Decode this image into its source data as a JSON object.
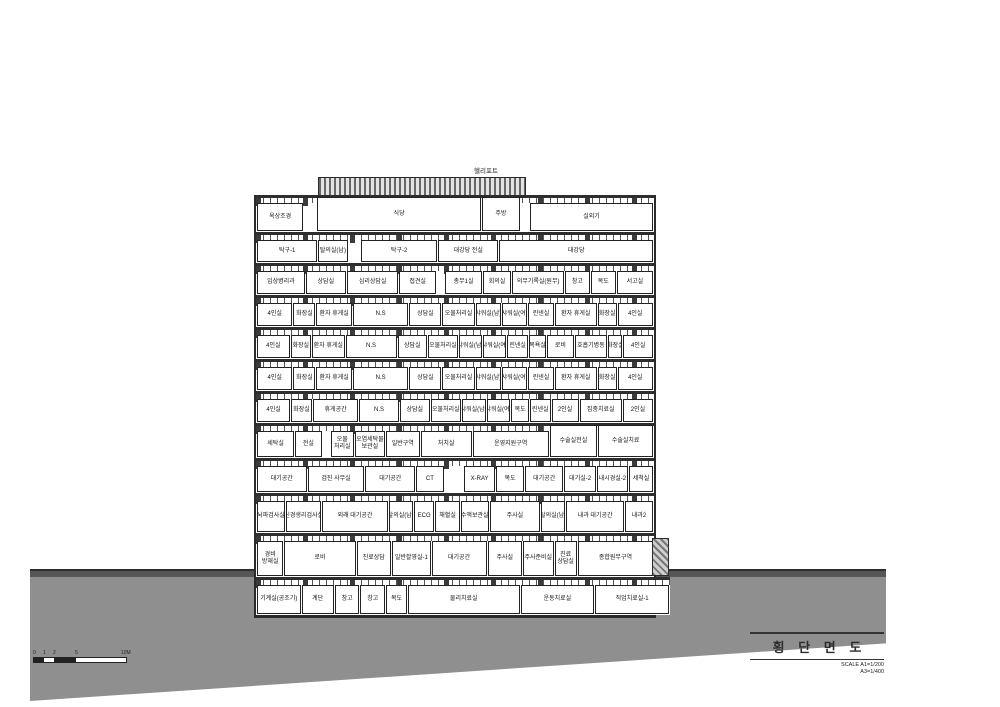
{
  "roof_label": "헬리포트",
  "title_block": {
    "title": "횡 단 면 도",
    "scale_line1": "SCALE  A1=1/200",
    "scale_line2": "A3=1/400"
  },
  "scale_bar": {
    "labels": [
      {
        "t": "0",
        "x": 0
      },
      {
        "t": "1",
        "x": 10
      },
      {
        "t": "2",
        "x": 20
      },
      {
        "t": "5",
        "x": 42
      },
      {
        "t": "10M",
        "x": 88
      }
    ],
    "segments": [
      {
        "w": 10,
        "filled": true
      },
      {
        "w": 10,
        "filled": false
      },
      {
        "w": 22,
        "filled": true
      },
      {
        "w": 50,
        "filled": false
      }
    ]
  },
  "floors": [
    {
      "id": "roof",
      "h": 37,
      "rooms": [
        {
          "label": "옥상조경",
          "w": 11
        },
        {
          "label": "",
          "w": 3
        },
        {
          "label": "식당",
          "w": 40,
          "raised": true
        },
        {
          "label": "주방",
          "w": 9,
          "raised": true
        },
        {
          "label": "",
          "w": 2
        },
        {
          "label": "실외기",
          "w": 30
        }
      ]
    },
    {
      "id": "f11",
      "h": 31,
      "rooms": [
        {
          "label": "탁구-1",
          "w": 15
        },
        {
          "label": "탈의실(남)",
          "w": 7
        },
        {
          "label": "",
          "w": 3
        },
        {
          "label": "탁구-2",
          "w": 19
        },
        {
          "label": "대강당 전실",
          "w": 15
        },
        {
          "label": "대강당",
          "w": 39
        }
      ]
    },
    {
      "id": "f10",
      "h": 32,
      "rooms": [
        {
          "label": "임상병리과",
          "w": 12
        },
        {
          "label": "상담실",
          "w": 10
        },
        {
          "label": "심리상담실",
          "w": 13
        },
        {
          "label": "접견실",
          "w": 9
        },
        {
          "label": "",
          "w": 2
        },
        {
          "label": "총무1실",
          "w": 9
        },
        {
          "label": "회의실",
          "w": 7
        },
        {
          "label": "의무기록실(원무)",
          "w": 13
        },
        {
          "label": "창고",
          "w": 6
        },
        {
          "label": "복도",
          "w": 6
        },
        {
          "label": "서고실",
          "w": 9
        }
      ]
    },
    {
      "id": "ward-a",
      "h": 32,
      "rooms": [
        {
          "label": "4인실",
          "w": 10
        },
        {
          "label": "화장실",
          "w": 6
        },
        {
          "label": "환자 휴게실",
          "w": 10
        },
        {
          "label": "N.S",
          "w": 16
        },
        {
          "label": "상담실",
          "w": 9
        },
        {
          "label": "오물처리실",
          "w": 9
        },
        {
          "label": "샤워실(남)",
          "w": 7
        },
        {
          "label": "샤워실(여)",
          "w": 7
        },
        {
          "label": "린넨실",
          "w": 7
        },
        {
          "label": "환자 휴게실",
          "w": 12
        },
        {
          "label": "화장실",
          "w": 5
        },
        {
          "label": "4인실",
          "w": 10
        }
      ]
    },
    {
      "id": "ward-b",
      "h": 32,
      "rooms": [
        {
          "label": "4인실",
          "w": 10
        },
        {
          "label": "화장실",
          "w": 6
        },
        {
          "label": "환자 휴게실",
          "w": 10
        },
        {
          "label": "N.S",
          "w": 16
        },
        {
          "label": "상담실",
          "w": 9
        },
        {
          "label": "오물처리실",
          "w": 9
        },
        {
          "label": "샤워실(남)",
          "w": 7
        },
        {
          "label": "샤워실(여)",
          "w": 7
        },
        {
          "label": "린넨실",
          "w": 6
        },
        {
          "label": "목욕실",
          "w": 5
        },
        {
          "label": "로비",
          "w": 8
        },
        {
          "label": "호흡기병동",
          "w": 10
        },
        {
          "label": "화장실",
          "w": 4
        },
        {
          "label": "4인실",
          "w": 9
        }
      ]
    },
    {
      "id": "ward-c",
      "h": 32,
      "rooms": [
        {
          "label": "4인실",
          "w": 10
        },
        {
          "label": "화장실",
          "w": 6
        },
        {
          "label": "환자 휴게실",
          "w": 10
        },
        {
          "label": "N.S",
          "w": 16
        },
        {
          "label": "상담실",
          "w": 9
        },
        {
          "label": "오물처리실",
          "w": 9
        },
        {
          "label": "샤워실(남)",
          "w": 7
        },
        {
          "label": "샤워실(여)",
          "w": 7
        },
        {
          "label": "린넨실",
          "w": 7
        },
        {
          "label": "환자 휴게실",
          "w": 12
        },
        {
          "label": "화장실",
          "w": 5
        },
        {
          "label": "4인실",
          "w": 10
        }
      ]
    },
    {
      "id": "ward-d",
      "h": 32,
      "rooms": [
        {
          "label": "4인실",
          "w": 10
        },
        {
          "label": "화장실",
          "w": 6
        },
        {
          "label": "휴게공간",
          "w": 14
        },
        {
          "label": "N.S",
          "w": 12
        },
        {
          "label": "상담실",
          "w": 9
        },
        {
          "label": "오물처리실",
          "w": 9
        },
        {
          "label": "샤워실(남)",
          "w": 7
        },
        {
          "label": "샤워실(여)",
          "w": 7
        },
        {
          "label": "복도",
          "w": 5
        },
        {
          "label": "린넨실",
          "w": 6
        },
        {
          "label": "2인실",
          "w": 8
        },
        {
          "label": "집중치료실",
          "w": 13
        },
        {
          "label": "2인실",
          "w": 9
        }
      ]
    },
    {
      "id": "f4",
      "h": 35,
      "rooms": [
        {
          "label": "세탁실",
          "w": 10
        },
        {
          "label": "전실",
          "w": 7
        },
        {
          "label": "",
          "w": 2
        },
        {
          "label": "오물처리실",
          "lines": [
            "오물",
            "처리실"
          ],
          "w": 6
        },
        {
          "label": "오염세탁물보관실",
          "lines": [
            "오염세탁물",
            "보관실"
          ],
          "w": 8
        },
        {
          "label": "일반구역",
          "w": 9
        },
        {
          "label": "처치실",
          "w": 14
        },
        {
          "label": "운영지원구역",
          "w": 21
        },
        {
          "label": "수술실전실",
          "w": 13,
          "raised": true
        },
        {
          "label": "수술실치료",
          "w": 15,
          "raised": true
        }
      ]
    },
    {
      "id": "f3",
      "h": 35,
      "rooms": [
        {
          "label": "대기공간",
          "w": 13
        },
        {
          "label": "검진 사무실",
          "w": 15
        },
        {
          "label": "대기공간",
          "w": 13
        },
        {
          "label": "CT",
          "w": 7
        },
        {
          "label": "",
          "w": 5
        },
        {
          "label": "X-RAY",
          "w": 8
        },
        {
          "label": "복도",
          "w": 7
        },
        {
          "label": "대기공간",
          "w": 10
        },
        {
          "label": "대기실-2",
          "w": 8
        },
        {
          "label": "내시경실-2",
          "w": 8
        },
        {
          "label": "세척실",
          "w": 6
        }
      ]
    },
    {
      "id": "f2",
      "h": 40,
      "rooms": [
        {
          "label": "뇌파검사실",
          "w": 7
        },
        {
          "label": "신경생리검사실",
          "w": 9
        },
        {
          "label": "외래 대기공간",
          "w": 17
        },
        {
          "label": "탈의실(남)",
          "w": 6
        },
        {
          "label": "ECG",
          "w": 5
        },
        {
          "label": "채혈실",
          "w": 6
        },
        {
          "label": "수액보관실",
          "w": 7
        },
        {
          "label": "주사실",
          "w": 13
        },
        {
          "label": "탈의실(남)",
          "w": 6
        },
        {
          "label": "내과 대기공간",
          "w": 15
        },
        {
          "label": "내과2",
          "w": 7
        }
      ]
    },
    {
      "id": "f1",
      "h": 44,
      "rooms": [
        {
          "label": "경비 방재실",
          "lines": [
            "경비",
            "방재실"
          ],
          "w": 6
        },
        {
          "label": "로비",
          "w": 17
        },
        {
          "label": "진료상담",
          "w": 8
        },
        {
          "label": "일반촬영실-1",
          "w": 9
        },
        {
          "label": "대기공간",
          "w": 13
        },
        {
          "label": "주사실",
          "w": 8
        },
        {
          "label": "주사준비실",
          "w": 7
        },
        {
          "label": "진료상담실",
          "lines": [
            "진료",
            "상담실"
          ],
          "w": 5
        },
        {
          "label": "종합원무구역",
          "w": 18
        }
      ]
    },
    {
      "id": "b1",
      "h": 38,
      "wpx": 414,
      "rooms": [
        {
          "label": "기계실(공조기)",
          "w": 11
        },
        {
          "label": "계단",
          "w": 8
        },
        {
          "label": "창고",
          "w": 6
        },
        {
          "label": "창고",
          "w": 6
        },
        {
          "label": "복도",
          "w": 5
        },
        {
          "label": "물리치료실",
          "w": 29
        },
        {
          "label": "운동치료실",
          "w": 19
        },
        {
          "label": "직업치료실-1",
          "w": 19
        }
      ]
    }
  ]
}
